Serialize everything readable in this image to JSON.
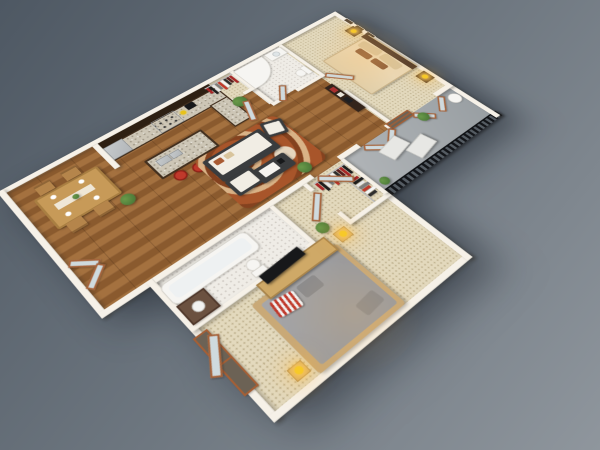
{
  "scene": {
    "type": "3d-isometric-floor-plan",
    "unit": "two-bedroom apartment with balcony"
  },
  "colors": {
    "background_top": "#4e5863",
    "background_bottom": "#8f969d",
    "wall": "#f6f1e8",
    "wall_shade": "#cfc7ba",
    "wood_floor_a": "#a4713f",
    "wood_floor_b": "#8a5a2e",
    "carpet": "#e3d9bd",
    "carpet_dot": "#b9ab87",
    "tile": "#efece6",
    "concrete_a": "#b0b4b7",
    "concrete_b": "#989ea2",
    "cabinet_dark": "#43301f",
    "cabinet_upper": "#2e2013",
    "granite": "#cdc6b6",
    "steel": "#b3b7ba",
    "stool_red": "#c0392b",
    "rug_rust": "#a8552a",
    "rug_cream": "#e9dcc6",
    "sofa_frame": "#3a3c3e",
    "sofa_cushion": "#f1ede4",
    "wood_accent": "#a55f35",
    "door_glass": "#cfdade",
    "table_wood": "#c79a58",
    "chair_wood": "#b5854b",
    "bed_cream": "#ead9b8",
    "pillow_tan": "#d8c49c",
    "headboard": "#553d2b",
    "nightstand": "#4a362a",
    "lamp_yellow": "#f7c928",
    "bed_gray": "#9b9b9d",
    "platform_wood": "#c9a977",
    "dresser_wood": "#cfa967",
    "tv_black": "#17181a",
    "console_dark": "#33241b",
    "plant_green": "#4e7c3a",
    "fixture_white": "#f6f5f2",
    "fixture_border": "#d6d3cc",
    "railing_dark": "#14161a",
    "railing_gap": "#555c63",
    "lounge_white": "#e7e7e4",
    "stripe_red": "#c0392b",
    "stripe_white": "#f2f2f2"
  },
  "closet": {
    "clothes_colors": [
      "#a82828",
      "#1e1e1e",
      "#e8e8e8",
      "#7d7d7d",
      "#c0392b",
      "#f4f4f4",
      "#2e2e2e",
      "#5a1f1f"
    ]
  },
  "rooms": {
    "kitchen": {
      "items": [
        "upper-cabinets",
        "granite-counter",
        "fridge",
        "stove",
        "coffee-maker",
        "island-with-sink",
        "bar-stools"
      ]
    },
    "dining": {
      "items": [
        "dining-table",
        "four-chairs",
        "place-settings",
        "potted-plant"
      ]
    },
    "living": {
      "items": [
        "sectional-sofa",
        "armchair",
        "coffee-table",
        "area-rug",
        "tv-console",
        "plants"
      ]
    },
    "master_bedroom": {
      "items": [
        "double-bed",
        "headboard",
        "nightstands",
        "lit-lamps",
        "wall-frames"
      ]
    },
    "master_bathroom": {
      "items": [
        "corner-tub",
        "vanity",
        "toilet"
      ]
    },
    "hall_closet": {
      "items": [
        "hanging-clothes"
      ]
    },
    "second_bathroom": {
      "items": [
        "bathtub",
        "toilet",
        "vanity"
      ]
    },
    "second_bedroom": {
      "items": [
        "platform-bed",
        "striped-pillow",
        "tv-dresser",
        "lamps",
        "plant"
      ]
    },
    "walk_in_closet": {
      "items": [
        "hanging-clothes-racks"
      ]
    },
    "balcony": {
      "items": [
        "lounge-chairs",
        "round-table",
        "plants",
        "metal-railing"
      ]
    }
  }
}
